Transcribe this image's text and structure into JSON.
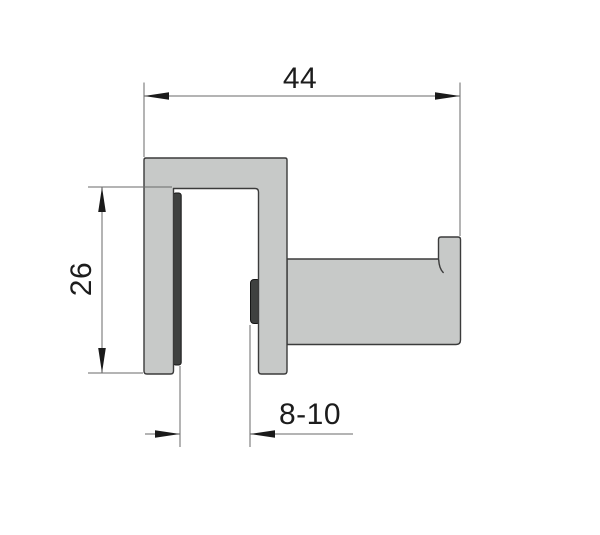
{
  "drawing": {
    "kind": "technical-drawing",
    "subject": "glass-door-hook-clamp-cross-section",
    "dimensions": {
      "overall_width": "44",
      "clamp_depth": "26",
      "glass_thickness_range": "8-10"
    }
  },
  "colors": {
    "background": "#ffffff",
    "part_fill": "#c7c9c8",
    "part_outline": "#3b3b3b",
    "gasket_fill": "#3f4140",
    "gasket_outline": "#161616",
    "dim_line": "#6a6a6a",
    "dim_arrow": "#1a1a1a",
    "dim_text": "#1c1c1c"
  }
}
